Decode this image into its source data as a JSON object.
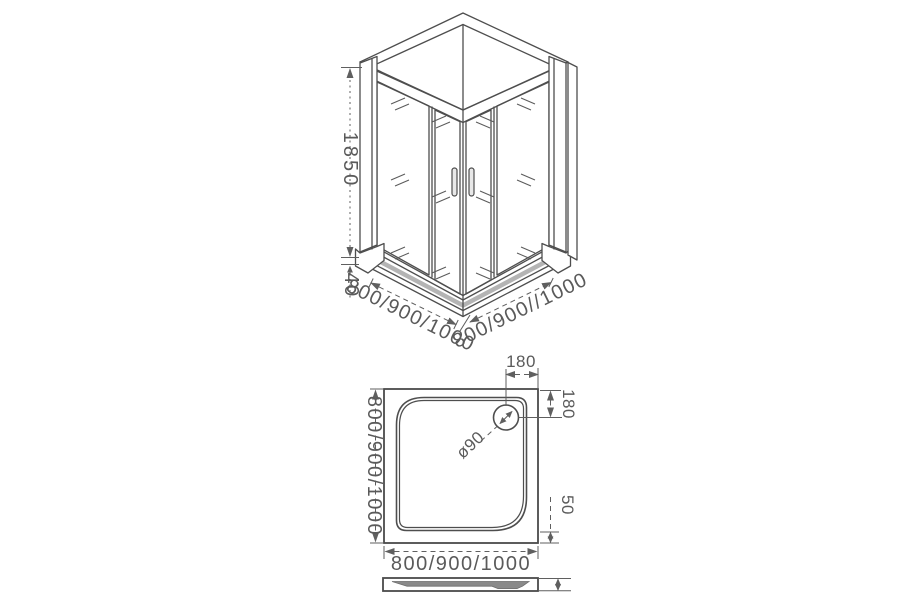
{
  "drawing": {
    "isometric_view": {
      "height_label": "1850",
      "tray_height_label": "40",
      "width_label_left": "800/900/1000",
      "width_label_right": "800/900//1000"
    },
    "plan_view": {
      "drain_offset_top_label": "180",
      "drain_offset_right_label": "180",
      "drain_diameter_label": "ø90",
      "rim_height_label": "50",
      "width_label_bottom": "800/900/1000",
      "depth_label_left": "800/900/1000"
    },
    "colors": {
      "line": "#4e4e4e",
      "dimension": "#5f5f5f",
      "text": "#5a5a5a",
      "tray_band": "#b4b4b4",
      "tray_surface": "#8a8a8a",
      "background": "#ffffff"
    }
  }
}
